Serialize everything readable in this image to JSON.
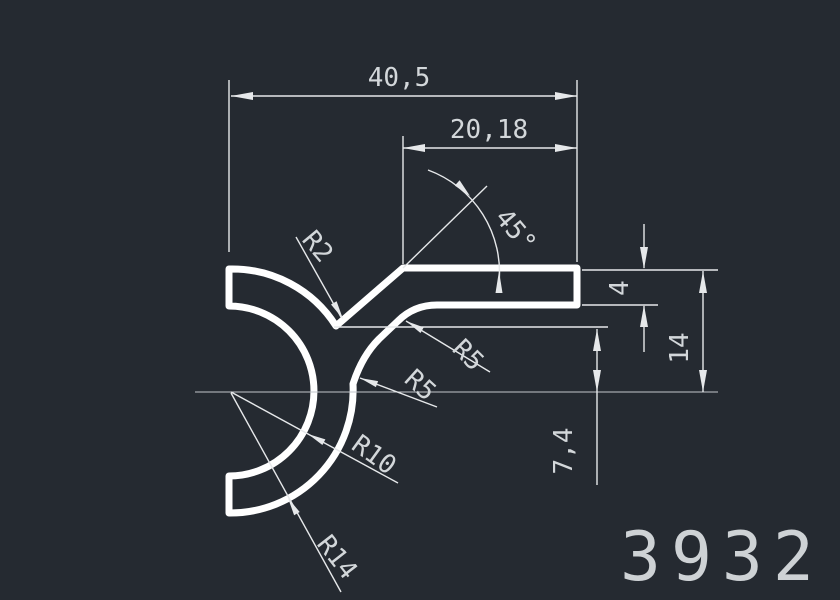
{
  "drawing": {
    "part_number": "3932",
    "dimensions": {
      "overall_width": "40,5",
      "upper_width": "20,18",
      "angle": "45°",
      "radius_r2": "R2",
      "radius_r5_upper": "R5",
      "radius_r5_lower": "R5",
      "radius_r10": "R10",
      "radius_r14": "R14",
      "wall_thickness": "4",
      "arm_height": "14",
      "offset_height": "7,4"
    },
    "colors": {
      "background": "#252a31",
      "profile_line": "#ffffff",
      "dimension_line": "#e6e8ea",
      "dimension_text": "#d3d7da",
      "centerline": "#c2c6cb",
      "part_number_text": "#ced2d5"
    }
  }
}
